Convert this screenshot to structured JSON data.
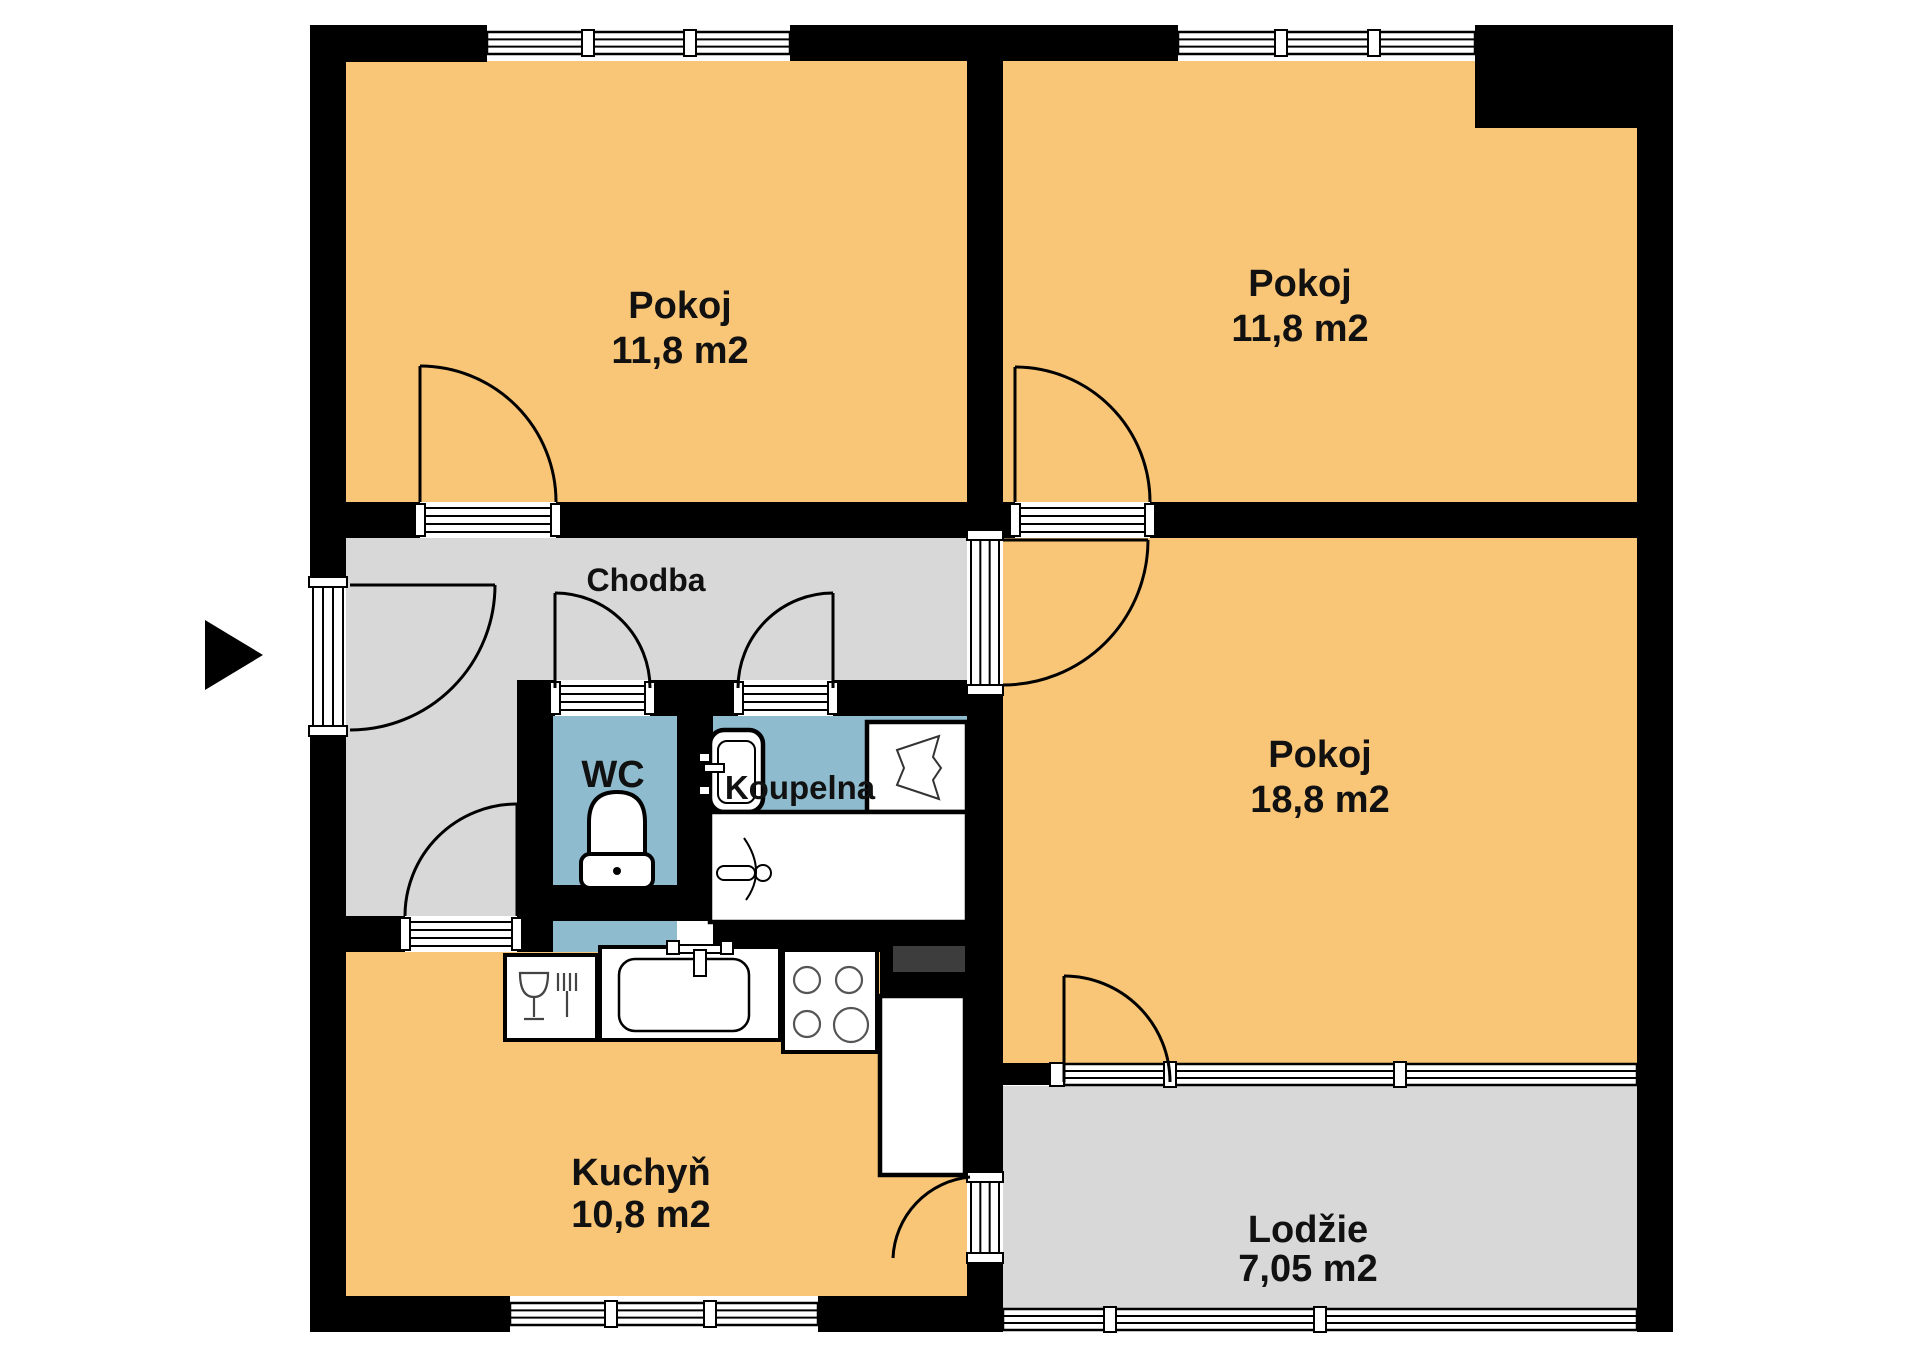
{
  "plan": {
    "background": "#ffffff",
    "wall_color": "#000000",
    "room_colors": {
      "living": "#F9C678",
      "corridor": "#D8D8D8",
      "bath": "#8FBBCF",
      "shaft": "#3d3d3d",
      "fixture": "#ffffff"
    },
    "entry_arrow": {
      "points": "205,620 205,690 263,655"
    },
    "rooms": [
      {
        "id": "pokoj-top-left",
        "label": "Pokoj",
        "area": "11,8 m2",
        "color": "living",
        "label_x": 680,
        "label_y": 318,
        "area_y": 363,
        "font": 38,
        "rects": [
          [
            346,
            61,
            621,
            441
          ]
        ]
      },
      {
        "id": "pokoj-top-right",
        "label": "Pokoj",
        "area": "11,8 m2",
        "color": "living",
        "label_x": 1300,
        "label_y": 296,
        "area_y": 341,
        "font": 38,
        "rects": [
          [
            1003,
            61,
            634,
            441
          ]
        ]
      },
      {
        "id": "pokoj-large",
        "label": "Pokoj",
        "area": "18,8 m2",
        "color": "living",
        "label_x": 1320,
        "label_y": 767,
        "area_y": 812,
        "font": 38,
        "rects": [
          [
            1003,
            538,
            634,
            526
          ]
        ]
      },
      {
        "id": "chodba",
        "label": "Chodba",
        "area": null,
        "color": "corridor",
        "label_x": 646,
        "label_y": 591,
        "area_y": null,
        "font": 32,
        "rects": [
          [
            346,
            538,
            621,
            142
          ],
          [
            346,
            680,
            171,
            236
          ]
        ]
      },
      {
        "id": "wc",
        "label": "WC",
        "area": null,
        "color": "bath",
        "label_x": 613,
        "label_y": 787,
        "area_y": null,
        "font": 38,
        "rects": [
          [
            553,
            716,
            124,
            169
          ],
          [
            553,
            921,
            124,
            31
          ]
        ]
      },
      {
        "id": "koupelna",
        "label": "Koupelna",
        "area": null,
        "color": "bath",
        "label_x": 800,
        "label_y": 799,
        "area_y": null,
        "font": 33,
        "rects": [
          [
            713,
            716,
            254,
            209
          ]
        ]
      },
      {
        "id": "kuchyn",
        "label": "Kuchyň",
        "area": "10,8 m2",
        "color": "living",
        "label_x": 641,
        "label_y": 1185,
        "area_y": 1227,
        "font": 38,
        "rects": [
          [
            346,
            952,
            621,
            344
          ]
        ]
      },
      {
        "id": "lodzie",
        "label": "Lodžie",
        "area": "7,05 m2",
        "color": "corridor",
        "label_x": 1308,
        "label_y": 1242,
        "area_y": 1281,
        "font": 38,
        "rects": [
          [
            1003,
            1086,
            634,
            222
          ]
        ]
      }
    ],
    "walls": [
      [
        310,
        25,
        36,
        1307
      ],
      [
        1637,
        25,
        36,
        1307
      ],
      [
        310,
        25,
        177,
        37
      ],
      [
        790,
        25,
        388,
        36
      ],
      [
        1475,
        25,
        198,
        103
      ],
      [
        310,
        1296,
        345,
        36
      ],
      [
        818,
        1296,
        185,
        36
      ],
      [
        967,
        61,
        36,
        1271
      ],
      [
        346,
        502,
        621,
        36
      ],
      [
        1003,
        502,
        634,
        36
      ],
      [
        517,
        680,
        450,
        36
      ],
      [
        517,
        680,
        36,
        272
      ],
      [
        677,
        680,
        36,
        205
      ],
      [
        517,
        885,
        196,
        36
      ],
      [
        713,
        920,
        254,
        32
      ],
      [
        346,
        916,
        171,
        36
      ],
      [
        880,
        950,
        87,
        46
      ],
      [
        1003,
        1063,
        47,
        22
      ]
    ],
    "shaft": [
      893,
      946,
      72,
      26
    ],
    "windows": [
      {
        "clear": [
          487,
          25,
          303,
          36
        ],
        "band": [
          487,
          32,
          303,
          22
        ],
        "mullions": [
          588,
          690
        ],
        "posts": []
      },
      {
        "clear": [
          1178,
          25,
          297,
          36
        ],
        "band": [
          1178,
          32,
          297,
          22
        ],
        "mullions": [
          1281,
          1374
        ],
        "posts": []
      },
      {
        "clear": [
          510,
          1296,
          308,
          36
        ],
        "band": [
          510,
          1303,
          308,
          22
        ],
        "mullions": [
          611,
          710
        ],
        "posts": []
      },
      {
        "clear": [
          1050,
          1063,
          587,
          23
        ],
        "band": [
          1064,
          1064,
          573,
          21
        ],
        "mullions": [
          1170,
          1400
        ],
        "posts": [
          [
            1050,
            1063,
            14,
            23
          ]
        ]
      },
      {
        "clear": [
          1003,
          1308,
          634,
          24
        ],
        "band": [
          1003,
          1309,
          634,
          21
        ],
        "mullions": [
          1110,
          1320
        ],
        "posts": []
      }
    ],
    "sills": [
      {
        "dir": "v",
        "clear": [
          310,
          582,
          36,
          149
        ],
        "band": [
          313,
          582,
          30,
          149
        ]
      },
      {
        "dir": "h",
        "clear": [
          420,
          502,
          136,
          36
        ],
        "band": [
          420,
          508,
          136,
          24
        ]
      },
      {
        "dir": "h",
        "clear": [
          1015,
          502,
          135,
          36
        ],
        "band": [
          1015,
          508,
          135,
          24
        ]
      },
      {
        "dir": "v",
        "clear": [
          967,
          535,
          36,
          155
        ],
        "band": [
          971,
          535,
          28,
          155
        ]
      },
      {
        "dir": "h",
        "clear": [
          555,
          680,
          95,
          36
        ],
        "band": [
          555,
          686,
          95,
          24
        ]
      },
      {
        "dir": "h",
        "clear": [
          738,
          680,
          95,
          36
        ],
        "band": [
          738,
          686,
          95,
          24
        ]
      },
      {
        "dir": "h",
        "clear": [
          405,
          916,
          112,
          36
        ],
        "band": [
          405,
          922,
          112,
          24
        ]
      },
      {
        "dir": "v",
        "clear": [
          967,
          1177,
          36,
          81
        ],
        "band": [
          971,
          1177,
          28,
          81
        ]
      }
    ],
    "doors": [
      {
        "id": "entry",
        "leaf": [
          350,
          585,
          495,
          585
        ],
        "arc": "M495,585 A145,145 0 0 1 350,730"
      },
      {
        "id": "pokoj-top-left",
        "leaf": [
          420,
          502,
          420,
          366
        ],
        "arc": "M420,366 A136,136 0 0 1 556,502"
      },
      {
        "id": "pokoj-top-right",
        "leaf": [
          1015,
          502,
          1015,
          367
        ],
        "arc": "M1015,367 A135,135 0 0 1 1150,502"
      },
      {
        "id": "pokoj-large",
        "leaf": [
          1003,
          540,
          1148,
          540
        ],
        "arc": "M1148,540 A145,145 0 0 1 1003,685"
      },
      {
        "id": "wc",
        "leaf": [
          555,
          688,
          555,
          593
        ],
        "arc": "M555,593 A95,95 0 0 1 650,688"
      },
      {
        "id": "koupelna",
        "leaf": [
          833,
          688,
          833,
          593
        ],
        "arc": "M833,593 A95,95 0 0 0 738,688"
      },
      {
        "id": "kuchyn",
        "leaf": [
          517,
          916,
          517,
          804
        ],
        "arc": "M517,804 A112,112 0 0 0 405,916"
      },
      {
        "id": "kuchyn-lodzie",
        "leaf": null,
        "arc": "M970,1177 A85,85 0 0 0 893,1258"
      },
      {
        "id": "pokoj-lodzie",
        "leaf": [
          1064,
          1082,
          1064,
          976
        ],
        "arc": "M1064,976 A106,106 0 0 1 1170,1082"
      }
    ],
    "fixtures": {
      "toilet": {
        "x": 581,
        "y": 790
      },
      "bath_sink": {
        "x": 710,
        "y": 730,
        "w": 53,
        "h": 82
      },
      "washer": {
        "x": 867,
        "y": 722,
        "w": 100,
        "h": 90
      },
      "tub": {
        "x": 710,
        "y": 812,
        "w": 257,
        "h": 110
      },
      "dishwasher": {
        "x": 505,
        "y": 955,
        "w": 92,
        "h": 85
      },
      "kitchen_sink": {
        "x": 600,
        "y": 947,
        "w": 180,
        "h": 93
      },
      "stove": {
        "x": 783,
        "y": 950,
        "w": 94,
        "h": 102
      },
      "fridge": {
        "x": 880,
        "y": 996,
        "w": 85,
        "h": 179
      }
    }
  }
}
